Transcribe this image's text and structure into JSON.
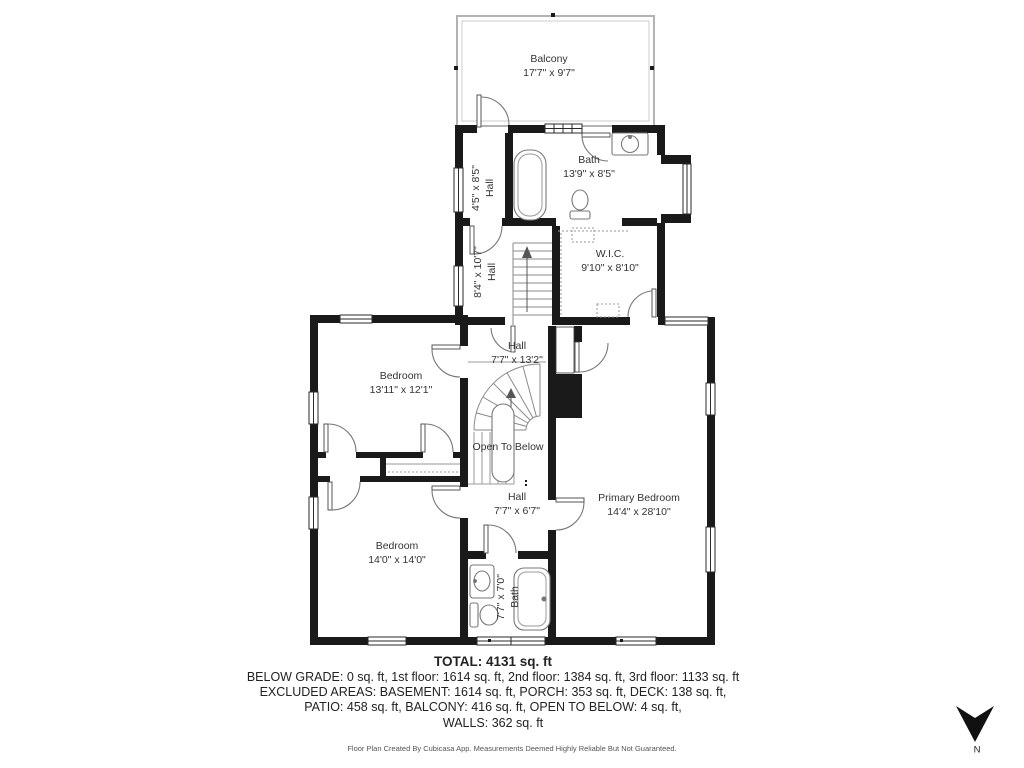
{
  "plan": {
    "rooms": [
      {
        "name": "Balcony",
        "dims": "17'7\" x 9'7\""
      },
      {
        "name": "Hall",
        "dims": "4'5\" x 8'5\""
      },
      {
        "name": "Bath",
        "dims": "13'9\" x 8'5\""
      },
      {
        "name": "W.I.C.",
        "dims": "9'10\" x 8'10\""
      },
      {
        "name": "Hall",
        "dims": "8'4\" x 10'7\""
      },
      {
        "name": "Hall",
        "dims": "7'7\" x 13'2\""
      },
      {
        "name": "Bedroom",
        "dims": "13'11\" x 12'1\""
      },
      {
        "name": "Open To Below",
        "dims": ""
      },
      {
        "name": "Primary Bedroom",
        "dims": "14'4\" x 28'10\""
      },
      {
        "name": "Hall",
        "dims": "7'7\" x 6'7\""
      },
      {
        "name": "Bedroom",
        "dims": "14'0\" x 14'0\""
      },
      {
        "name": "Bath",
        "dims": "7'7\" x 7'0\""
      }
    ],
    "summary": {
      "total": "TOTAL: 4131 sq. ft",
      "line1": "BELOW GRADE: 0 sq. ft, 1st floor: 1614 sq. ft, 2nd floor: 1384 sq. ft, 3rd floor: 1133 sq. ft",
      "line2": "EXCLUDED AREAS: BASEMENT: 1614 sq. ft, PORCH: 353 sq. ft, DECK: 138 sq. ft,",
      "line3": "PATIO: 458 sq. ft, BALCONY: 416 sq. ft, OPEN TO BELOW: 4 sq. ft,",
      "line4": "WALLS: 362 sq. ft"
    },
    "footer": "Floor Plan Created By Cubicasa App. Measurements Deemed Highly Reliable But Not Guaranteed.",
    "compass": {
      "label": "N"
    },
    "colors": {
      "wall": "#1a1a1a",
      "background": "#ffffff",
      "fixture_line": "#777777"
    }
  }
}
